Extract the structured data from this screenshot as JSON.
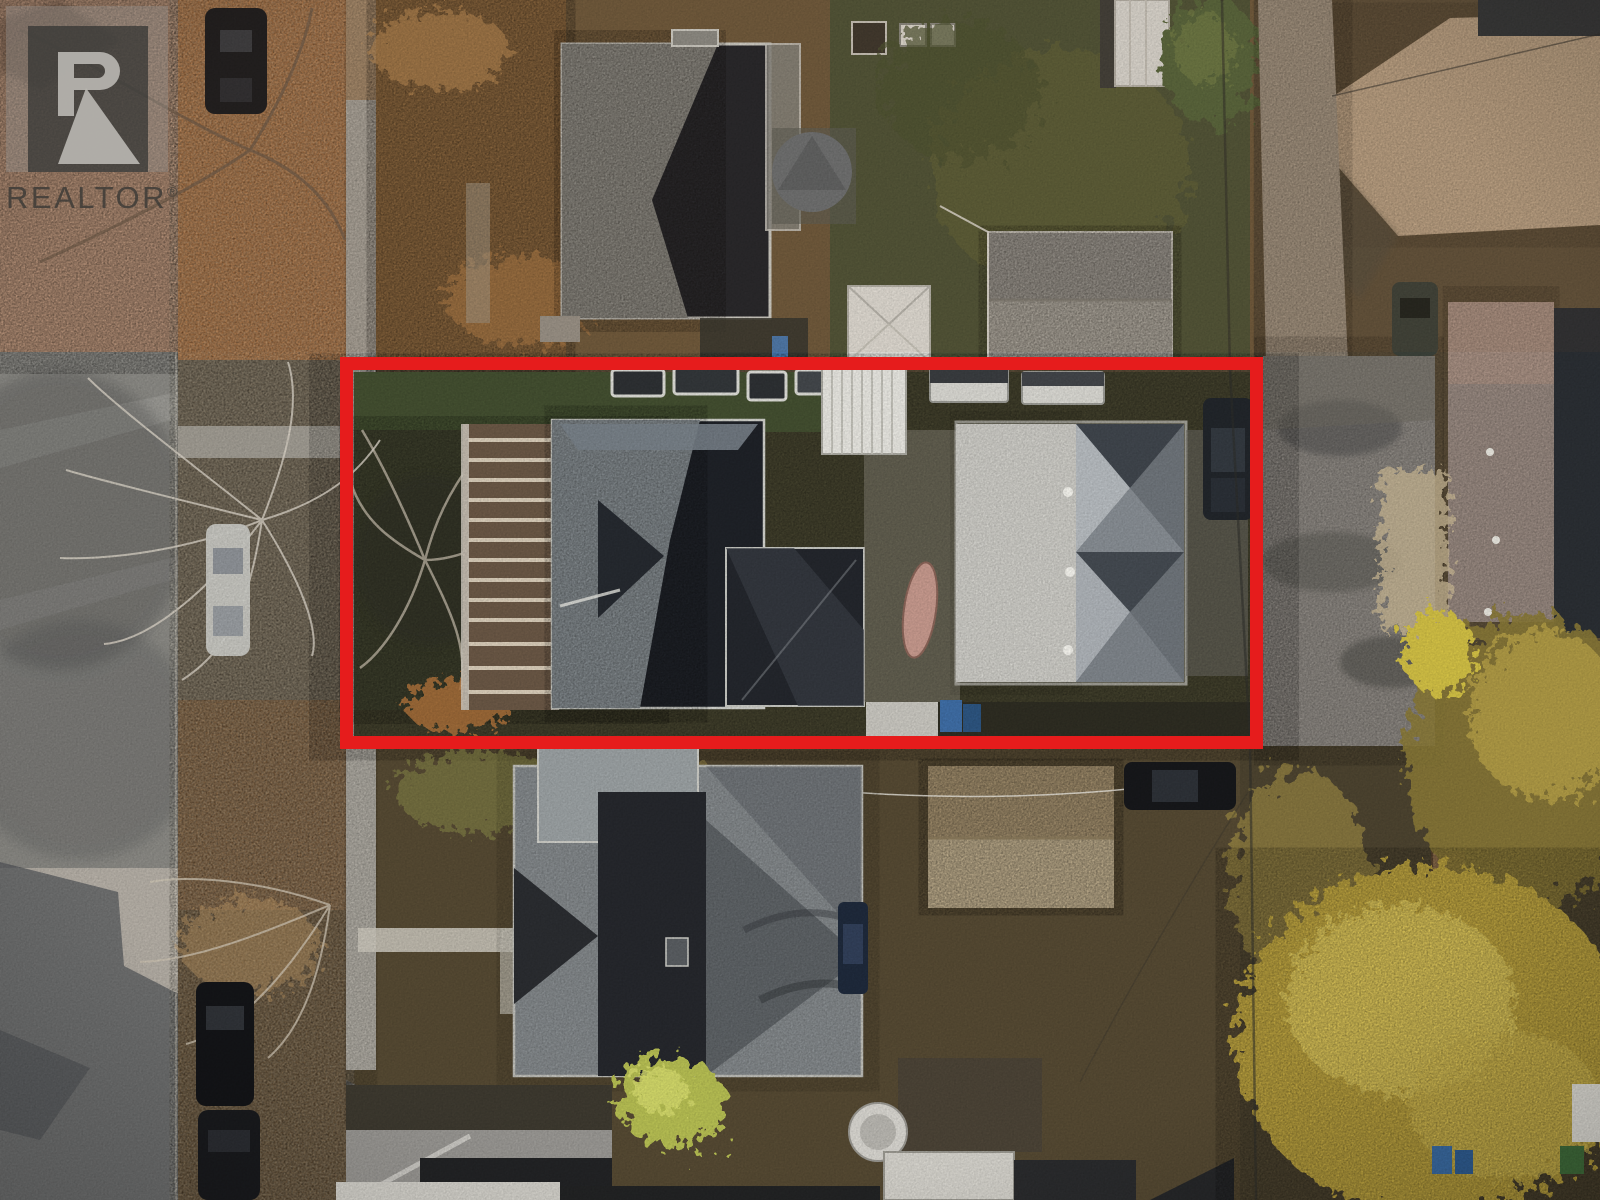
{
  "photo": {
    "alt": "Aerial drone view of a residential lot outlined in red, showing two houses on the subject property, neighbouring homes, a street on the left and autumn trees on the right",
    "outline_color": "#e61c1c"
  },
  "watermark": {
    "brand": "REALTOR",
    "registered": "®",
    "logo_letter": "R"
  }
}
